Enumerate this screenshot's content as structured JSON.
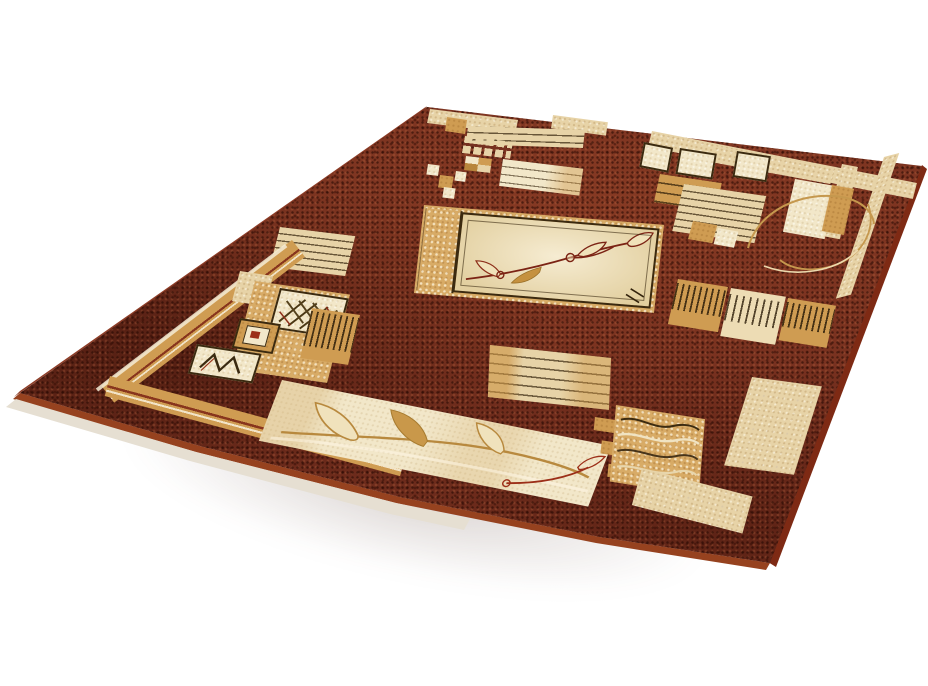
{
  "scene": {
    "type": "product-photo",
    "subject": "rectangular patterned area rug",
    "description": "Brown oriental-style rug with beige, cream and gold geometric patches, a central square leaf-vine medallion, striped blocks, small ornament squares and corner L-frames, photographed at a perspective angle on a plain white background",
    "background_color": "#ffffff"
  },
  "colors": {
    "bg": "#ffffff",
    "field": "#76301f",
    "field_dark": "#3f1408",
    "field_light": "#a2553a",
    "beige": "#e7d3a7",
    "cream": "#f2e7c9",
    "gold": "#cf9c52",
    "gold_deep": "#b8863c",
    "gold_speckled": "#d8ab66",
    "outline_dark": "#3b2a10",
    "stem_red": "#7b2314",
    "accent_red": "#9c2f18",
    "edge_lip": "#96421f",
    "edge_backing": "#e6dfd2"
  },
  "rug": {
    "corners_px": {
      "far_left": [
        427,
        107
      ],
      "far_right": [
        922,
        166
      ],
      "near_right": [
        770,
        563
      ],
      "near_left": [
        20,
        393
      ]
    },
    "motifs": [
      "central-leaf-medallion",
      "leaf-vine-band",
      "crosshatch-square",
      "diamond-eye-square",
      "zigzag-square",
      "striped-patches",
      "mosaic-square-grid",
      "barcode-stripe-blocks",
      "wavy-line-block",
      "corner-l-frames",
      "gold-border-band",
      "loop-curves",
      "step-ladder-squares"
    ]
  }
}
